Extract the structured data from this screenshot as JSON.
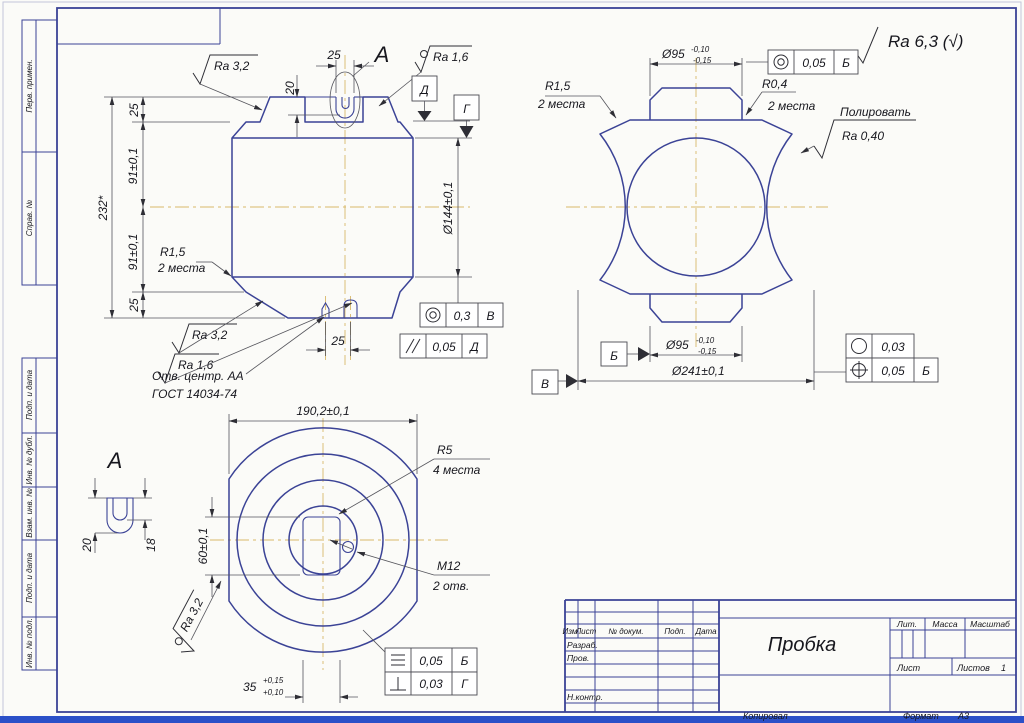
{
  "colors": {
    "line": "#3b4396",
    "thin": "#55555c",
    "centerline": "#d8b96a",
    "bottom_bar": "#2b50c8"
  },
  "drawing": {
    "general_roughness": "Ra 6,3 (√)",
    "margin_labels": [
      "Перв. примен.",
      "Справ. №",
      "Подп. и дата",
      "Инв. № дубл.",
      "Взам. инв. №",
      "Подп. и дата",
      "Инв. № подл."
    ],
    "front_view": {
      "slot_width_top": "25",
      "slot_depth": "20",
      "detail_label": "А",
      "ra_top_left": "Ra 3,2",
      "ra_top_right": "Ra 1,6",
      "datum_d": "Д",
      "datum_g": "Г",
      "dim_25_top": "25",
      "dim_91_upper": "91±0,1",
      "dim_91_lower": "91±0,1",
      "dim_25_bottom": "25",
      "dim_overall": "232*",
      "r15": "R1,5",
      "r15_note": "2 места",
      "ra_bottom_outer": "Ra 3,2",
      "ra_bottom_inner": "Ra 1,6",
      "center_hole_note_line1": "Отв. центр. АА",
      "center_hole_note_line2": "ГОСТ 14034-74",
      "slot_width_bottom": "25",
      "dia_bore": "Ø144±0,1",
      "fcf_concentricity": {
        "symbol": "concentricity",
        "value": "0,3",
        "datum": "В"
      },
      "fcf_parallelism": {
        "symbol": "parallelism",
        "value": "0,05",
        "datum": "Д"
      }
    },
    "side_view": {
      "dia_boss_top": "Ø95",
      "dia_boss_top_upper_tol": "-0,10",
      "dia_boss_top_lower_tol": "-0,15",
      "fcf_concentricity": {
        "symbol": "concentricity",
        "value": "0,05",
        "datum": "Б"
      },
      "r15": "R1,5",
      "r15_note": "2 места",
      "r04": "R0,4",
      "r04_note": "2 места",
      "polish_note": "Полировать",
      "polish_ra": "Ra 0,40",
      "datum_b": "Б",
      "datum_v": "В",
      "dia_boss_bottom": "Ø95",
      "dia_boss_bottom_upper_tol": "-0,10",
      "dia_boss_bottom_lower_tol": "-0,15",
      "dia_outer": "Ø241±0,1",
      "fcf_roundness": {
        "symbol": "roundness",
        "value": "0,03"
      },
      "fcf_position": {
        "symbol": "position",
        "value": "0,05",
        "datum": "Б"
      }
    },
    "top_view": {
      "dim_across_flats": "190,2±0,1",
      "r5": "R5",
      "r5_note": "4 места",
      "m12": "М12",
      "m12_note": "2 отв.",
      "dim_slot_height": "60±0,1",
      "ra": "Ra 3,2",
      "dim_slot_width": "35",
      "dim_slot_width_upper_tol": "+0,15",
      "dim_slot_width_lower_tol": "+0,10",
      "fcf_symmetry": {
        "symbol": "symmetry",
        "value": "0,05",
        "datum": "Б"
      },
      "fcf_perpendicularity": {
        "symbol": "perpendicularity",
        "value": "0,03",
        "datum": "Г"
      }
    },
    "detail_a": {
      "title": "А",
      "dim_outer_depth": "20",
      "dim_inner_depth": "18"
    },
    "title_block": {
      "header_cols": [
        "Изм.",
        "Лист",
        "№ докум.",
        "Подп.",
        "Дата"
      ],
      "row_developer": "Разраб.",
      "row_checker": "Пров.",
      "row_ncontrol": "Н.контр.",
      "part_name": "Пробка",
      "lit_label": "Лит.",
      "mass_label": "Масса",
      "scale_label": "Масштаб",
      "sheet_label": "Лист",
      "sheets_label": "Листов",
      "sheets_value": "1"
    },
    "footer": {
      "copied_label": "Копировал",
      "format_label": "Формат",
      "format_value": "А3"
    }
  }
}
